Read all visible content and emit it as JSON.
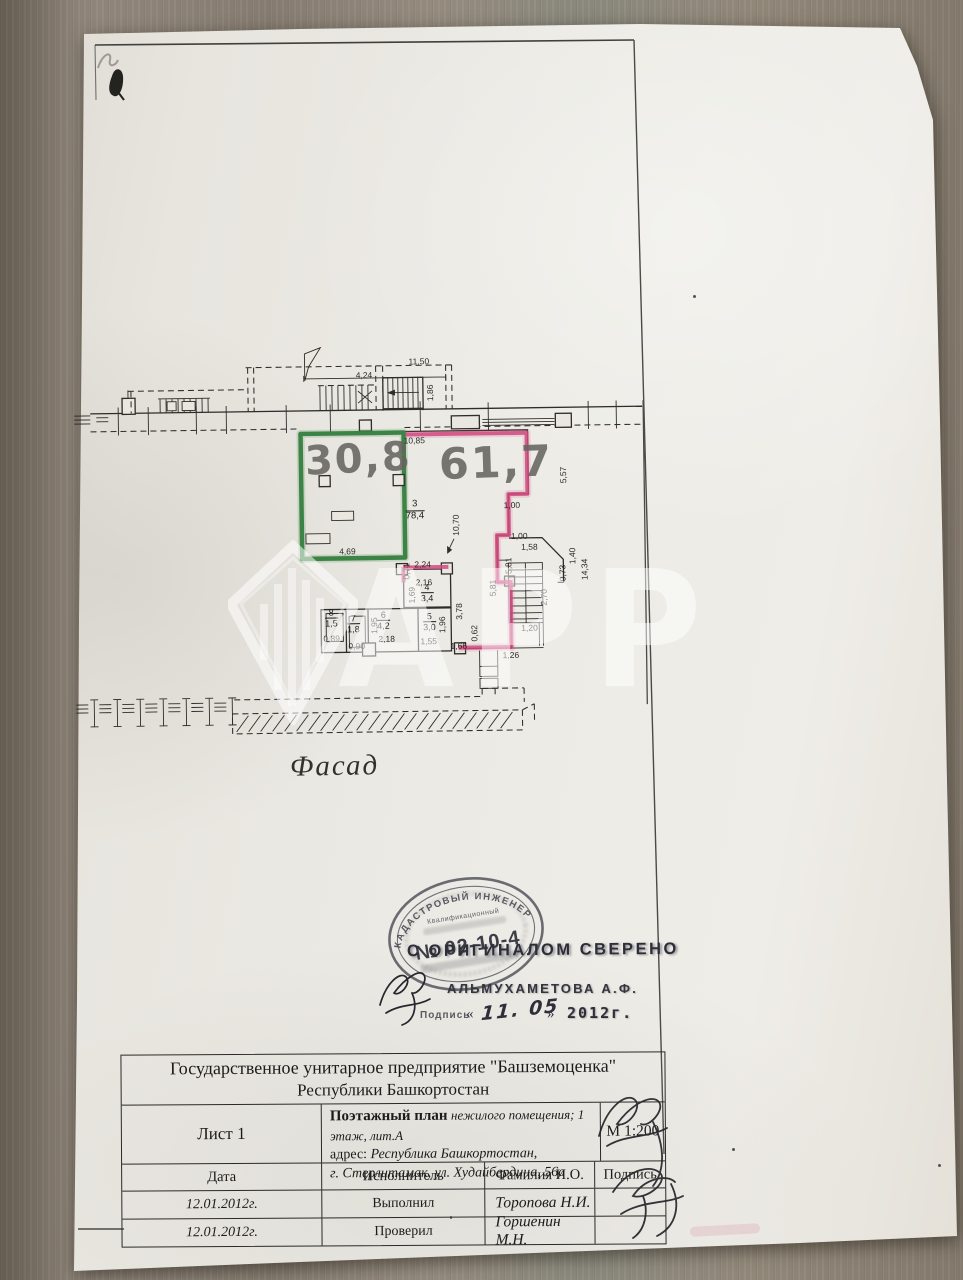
{
  "document": {
    "title": "ПОЭТАЖНЫЙ ПЛАН",
    "facade_label": "Фасад"
  },
  "plan": {
    "hand_areas": [
      "30,8",
      "61,7"
    ],
    "dims": [
      "4,24",
      "11,50",
      "1,86",
      "10,85",
      "4,69",
      "5,57",
      "1,00",
      "10,70",
      "2,24",
      "0,71",
      "2,16",
      "1,69",
      "3,78",
      "1,95",
      "2,18",
      "1,96",
      "1,55",
      "0,89",
      "0,90",
      "1,66",
      "0,62",
      "1,26",
      "1,00",
      "1,58",
      "5,81",
      "5,81",
      "2,70",
      "1,20",
      "0,73",
      "1,40",
      "14,34"
    ],
    "rooms": [
      {
        "n": "3",
        "a": "78,4"
      },
      {
        "n": "4",
        "a": "3,4"
      },
      {
        "n": "5",
        "a": "3,0"
      },
      {
        "n": "6",
        "a": "4,2"
      },
      {
        "n": "7",
        "a": "1,8"
      },
      {
        "n": "8",
        "a": "1,5"
      }
    ]
  },
  "watermark": {
    "text": "АРР"
  },
  "stamp": {
    "ring_text": "КАДАСТРОВЫЙ ИНЖЕНЕР",
    "qual_text": "Квалификационный",
    "number": "№ 02-10-4",
    "verified": "С ОРИГИНАЛОМ СВЕРЕНО",
    "name": "АЛЬМУХАМЕТОВА  А.Ф.",
    "sign_label": "Подпись",
    "quote_open": "«",
    "hand_date": "11. 05",
    "quote_close": "»",
    "year": "2012г."
  },
  "footer": {
    "org_line1": "Государственное унитарное предприятие \"Башземоценка\"",
    "org_line2": "Республики Башкортостан",
    "sheet": "Лист 1",
    "desc_bold": "Поэтажный план",
    "desc_italic": "нежилого помещения; 1 этаж, лит.А",
    "addr_label": "адрес:",
    "addr_line1": "Республика Башкортостан,",
    "addr_line2": "г. Стерлитамак, ул. Худайбердина,  56а",
    "scale": "М 1:200",
    "headers": {
      "date": "Дата",
      "role": "Исполнитель",
      "name": "Фамилия И.О.",
      "sign": "Подпись"
    },
    "rows": [
      {
        "date": "12.01.2012г.",
        "role": "Выполнил",
        "name": "Торопова Н.И."
      },
      {
        "date": "12.01.2012г.",
        "role": "Проверил",
        "name": "Горшенин М.Н."
      }
    ]
  },
  "colors": {
    "green_marker": "#35803f",
    "pink_marker": "#d1497f",
    "paper": "#e9e6e0",
    "stamp_ink": "#3f3f48"
  }
}
